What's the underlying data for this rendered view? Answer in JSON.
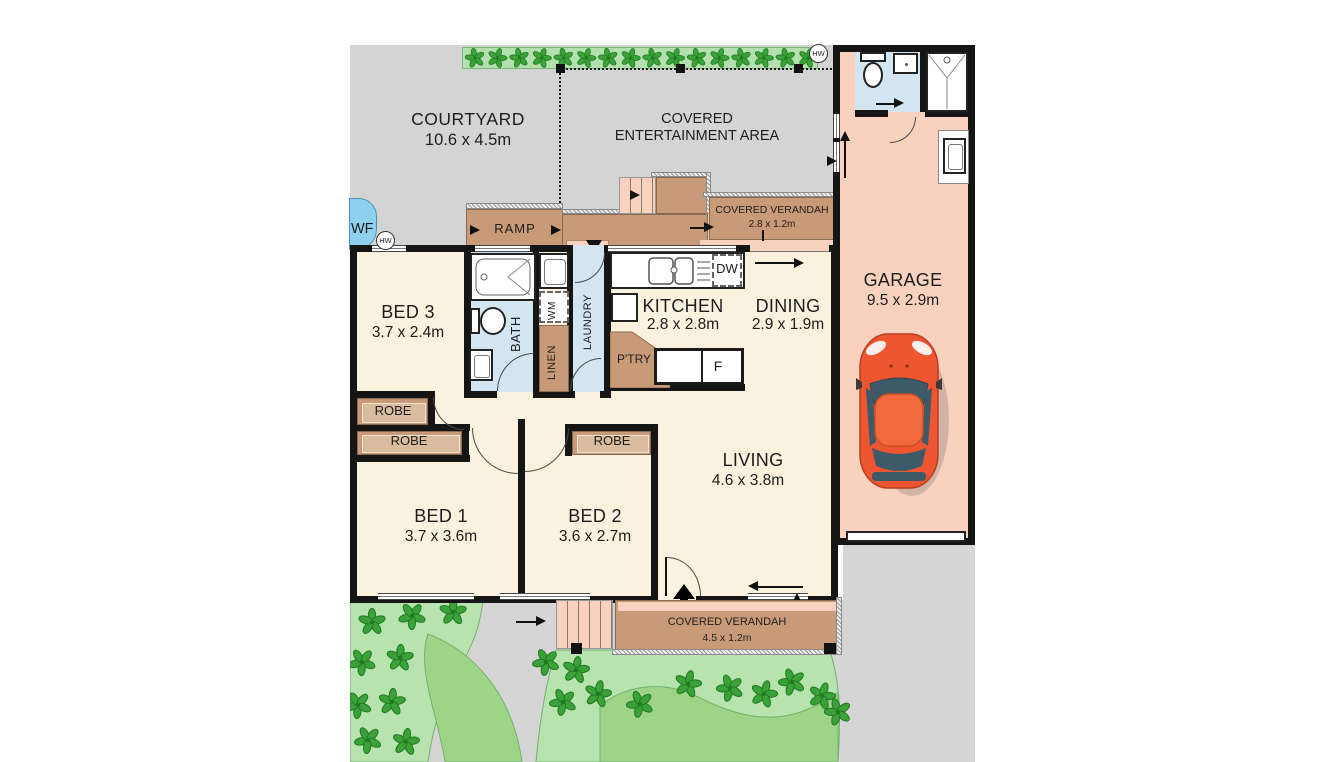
{
  "rooms": {
    "courtyard": {
      "name": "COURTYARD",
      "dims": "10.6 x 4.5m"
    },
    "entertainment": {
      "line1": "COVERED",
      "line2": "ENTERTAINMENT AREA"
    },
    "verandah_top": {
      "name": "COVERED VERANDAH",
      "dims": "2.8 x 1.2m"
    },
    "verandah_bottom": {
      "name": "COVERED VERANDAH",
      "dims": "4.5 x 1.2m"
    },
    "garage": {
      "name": "GARAGE",
      "dims": "9.5 x 2.9m"
    },
    "bed1": {
      "name": "BED 1",
      "dims": "3.7 x 3.6m"
    },
    "bed2": {
      "name": "BED 2",
      "dims": "3.6 x 2.7m"
    },
    "bed3": {
      "name": "BED 3",
      "dims": "3.7 x 2.4m"
    },
    "kitchen": {
      "name": "KITCHEN",
      "dims": "2.8 x 2.8m"
    },
    "dining": {
      "name": "DINING",
      "dims": "2.9 x 1.9m"
    },
    "living": {
      "name": "LIVING",
      "dims": "4.6 x 3.8m"
    }
  },
  "labels": {
    "bath": "BATH",
    "laundry": "LAUNDRY",
    "linen": "LINEN",
    "wm": "WM",
    "dw": "DW",
    "pantry": "P'TRY",
    "fridge": "F",
    "ramp": "RAMP",
    "robe": "ROBE",
    "wf": "WF",
    "hw": "HW"
  },
  "colors": {
    "wall": "#151515",
    "floor_cream": "#faf2de",
    "wet_area_blue": "#d3e5f1",
    "garage_salmon": "#f8d2bf",
    "deck_tan": "#c99a77",
    "outdoor_gray": "#d4d4d4",
    "garden_light_green": "#b7e3ae",
    "garden_dark_green": "#9ed487",
    "plant_green": "#3ba139",
    "water_blue": "#8fd0ee",
    "car_body_orange": "#ee5632"
  }
}
